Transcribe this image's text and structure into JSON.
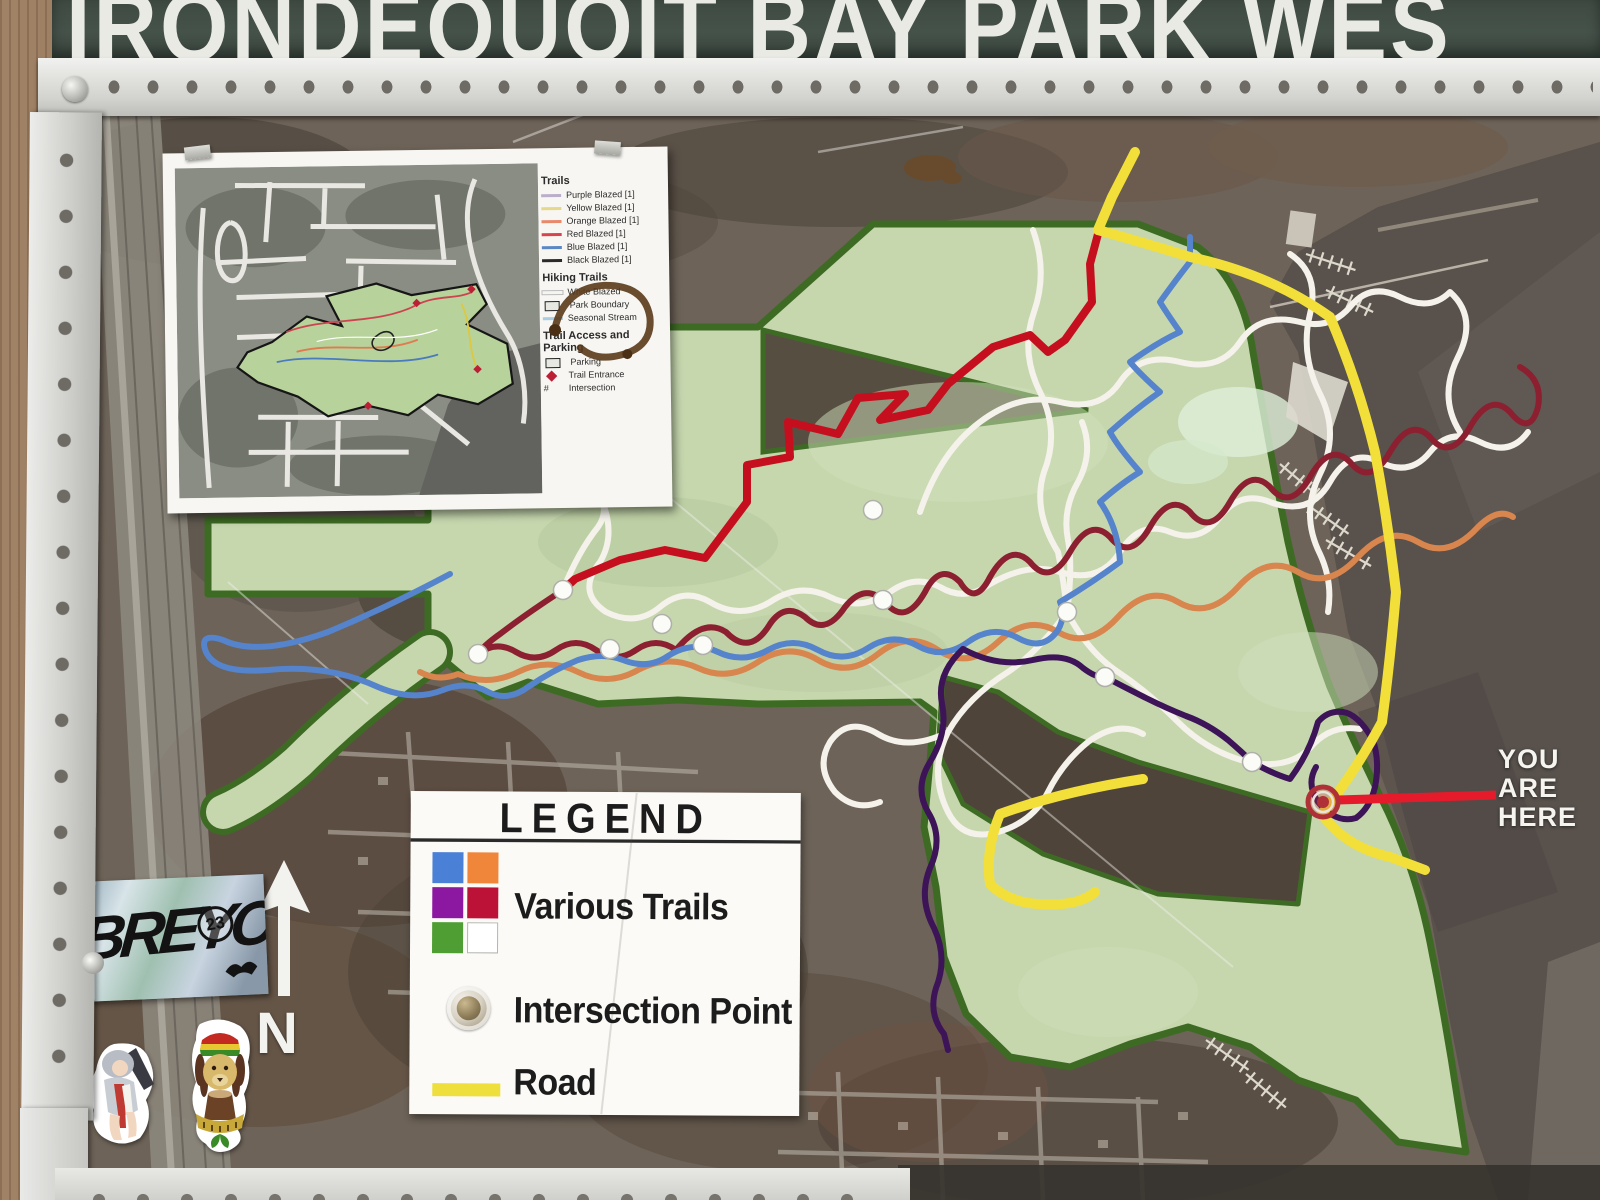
{
  "banner": {
    "title": "IRONDEQUOIT BAY PARK WES"
  },
  "you_are_here": {
    "line1": "YOU",
    "line2": "ARE",
    "line3": "HERE"
  },
  "compass": {
    "label": "N"
  },
  "legend_box": {
    "title": "LEGEND",
    "various_trails_label": "Various Trails",
    "intersection_label": "Intersection Point",
    "road_label": "Road",
    "swatch_colors": {
      "blue": "#4a80d6",
      "orange": "#f0863a",
      "purple": "#8c17a0",
      "crimson": "#bc1237",
      "green": "#4e9e33",
      "white": "#ffffff"
    },
    "road_color": "#efdf3d"
  },
  "inset_map": {
    "legend": {
      "heading_trails": "Trails",
      "trail_items": [
        {
          "label": "Purple Blazed [1]",
          "color": "#b9aecb"
        },
        {
          "label": "Yellow Blazed [1]",
          "color": "#e6d78a"
        },
        {
          "label": "Orange Blazed [1]",
          "color": "#e8896c"
        },
        {
          "label": "Red Blazed [1]",
          "color": "#d8444e"
        },
        {
          "label": "Blue Blazed [1]",
          "color": "#5b87c5"
        },
        {
          "label": "Black Blazed [1]",
          "color": "#2a2a2a"
        }
      ],
      "heading_hiking": "Hiking Trails",
      "hiking_items": [
        {
          "label": "White Blazed",
          "color": "#f5f5f0"
        },
        {
          "label": "Park Boundary",
          "color": "#1a1a1a"
        },
        {
          "label": "Seasonal Stream",
          "color": "#a8cde0"
        }
      ],
      "heading_access": "Trail Access and Parking",
      "access_items": [
        {
          "label": "Parking"
        },
        {
          "label": "Trail Entrance"
        },
        {
          "label": "Intersection"
        }
      ],
      "intersection_symbol": "#"
    }
  },
  "stickers": {
    "graffiti_tag": "BREYO",
    "graffiti_year": "23"
  },
  "map": {
    "colors": {
      "park_fill": "#c6d7ae",
      "park_border": "#3e6b24",
      "water": "#58514c",
      "trail_red": "#c50f1f",
      "trail_maroon": "#8c2030",
      "trail_orange": "#d8854e",
      "trail_blue": "#5583cc",
      "trail_white": "#f4f2ea",
      "trail_purple": "#3d1458",
      "road_yellow": "#f2df3a",
      "marker_red": "#e51b2c"
    }
  }
}
